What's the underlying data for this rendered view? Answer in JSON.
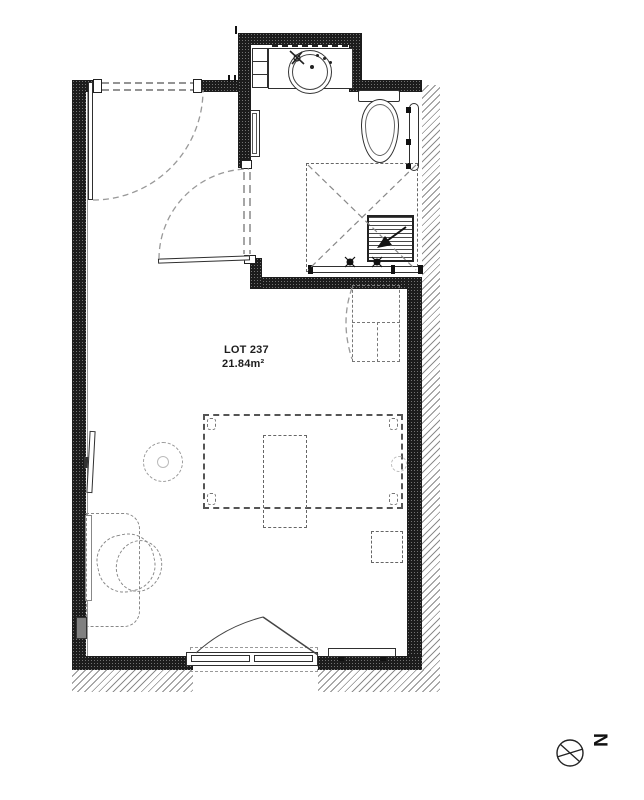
{
  "plan": {
    "lot_label": "LOT 237",
    "area_label": "21.84m²"
  },
  "compass": {
    "north_letter": "N"
  },
  "colors": {
    "wall_fill": "#1c1c1c",
    "line": "#2a2a2a",
    "furniture_dash": "#777777",
    "hatch_line": "#8c8c8c"
  },
  "fixtures": [
    "entry-door",
    "bathroom-door",
    "washbasin",
    "bathroom-cabinet",
    "mirror",
    "toilet",
    "towel-radiator",
    "shower-enclosure",
    "shower-tray",
    "mixer-valves",
    "kitchenette-unit",
    "bed",
    "bedside-table",
    "low-table",
    "pouf",
    "stool",
    "desk",
    "desk-chair",
    "tv",
    "radiator",
    "french-window",
    "column",
    "north-compass"
  ]
}
